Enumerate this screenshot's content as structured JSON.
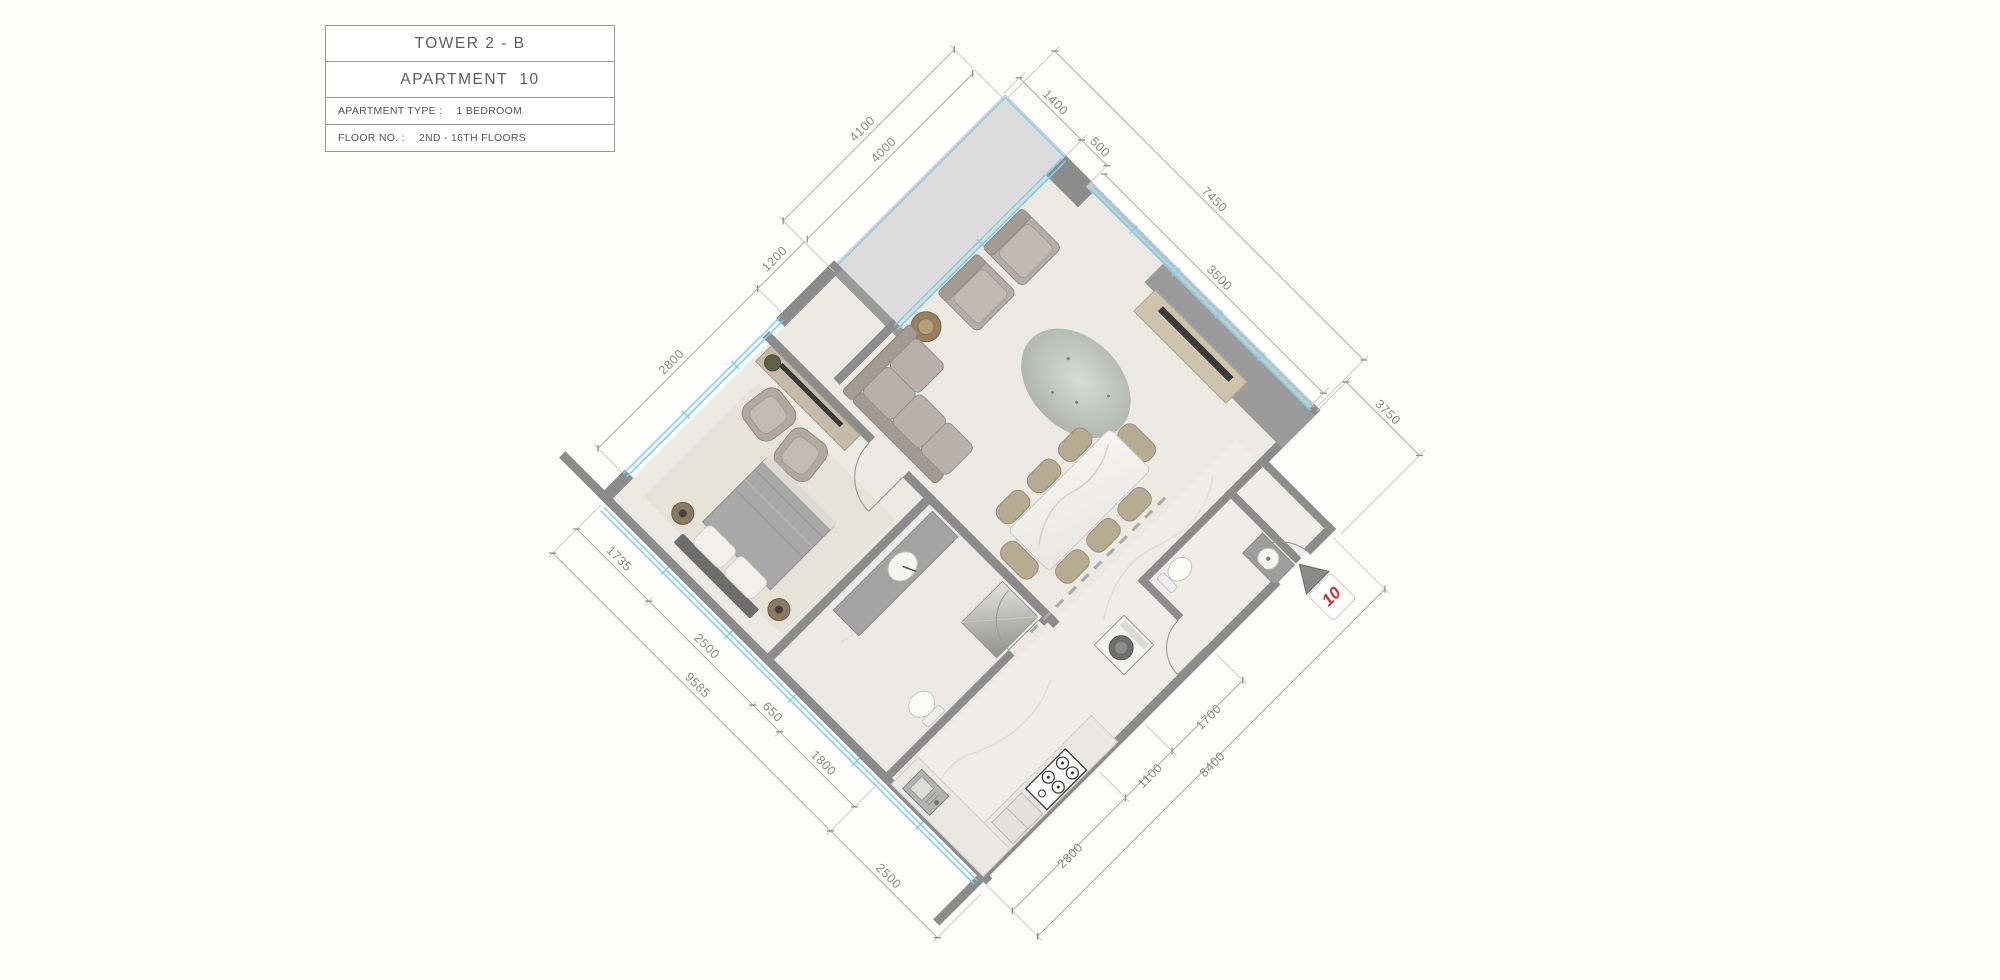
{
  "title_block": {
    "tower": "TOWER 2 - B",
    "apartment": "APARTMENT  10",
    "type_label": "APARTMENT TYPE :",
    "type_value": "1 BEDROOM",
    "floor_label": "FLOOR NO. :",
    "floor_value": "2ND - 16TH FLOORS"
  },
  "unit_marker": {
    "number": "10"
  },
  "dimensions": {
    "top": {
      "d1400": "1400",
      "d500": "500",
      "d3500": "3500",
      "d7450": "7450",
      "d3750": "3750"
    },
    "left": {
      "d4100": "4100",
      "d4000": "4000",
      "d1200": "1200",
      "d2800": "2800"
    },
    "bottom": {
      "d1735": "1735",
      "d2500_inner": "2500",
      "d650": "650",
      "d1800": "1800",
      "d9585": "9585",
      "d2500_outer": "2500"
    },
    "right": {
      "d1700": "1700",
      "d1100": "1100",
      "d2800": "2800",
      "d8400": "8400"
    }
  },
  "colors": {
    "window": "#7fcfec",
    "wall": "#8c8c8c",
    "marker_red": "#c23434",
    "dim_text": "#8a8a8a"
  }
}
